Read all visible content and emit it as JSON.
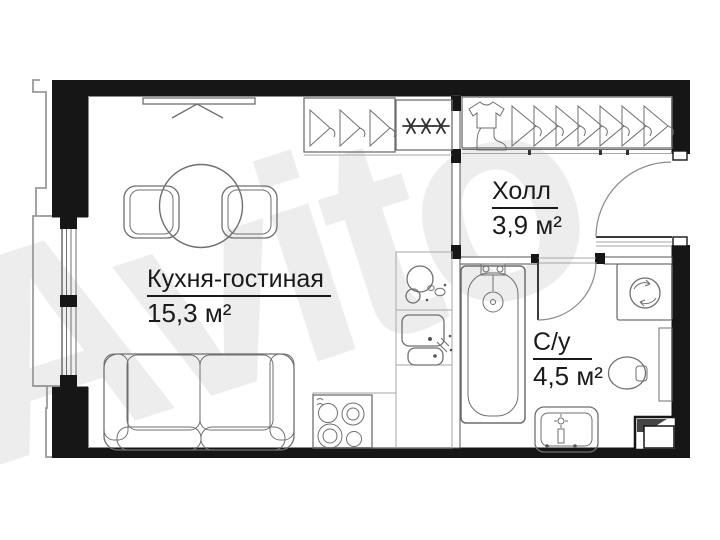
{
  "watermark": {
    "text": "Avito"
  },
  "rooms": {
    "kitchen_living": {
      "name": "Кухня-гостиная",
      "area": "15,3 м²"
    },
    "hall": {
      "name": "Холл",
      "area": "3,9 м²"
    },
    "bathroom": {
      "name": "С/у",
      "area": "4,5 м²"
    }
  },
  "fixtures": [
    "tv-icon",
    "round-dining-table-icon",
    "chair-icon",
    "sofa-icon",
    "wardrobe-hangers-icon",
    "wardrobe-shelves-icon",
    "shirt-icon",
    "boot-icon",
    "kitchen-sink-icon",
    "kitchen-cabinet-icon",
    "stove-icon",
    "bathtub-icon",
    "washing-machine-icon",
    "toilet-icon",
    "washbasin-icon",
    "ventilation-shaft-icon",
    "entrance-door-icon",
    "bathroom-door-icon",
    "window-icon",
    "balcony-outline"
  ],
  "colors": {
    "wall": "#161616",
    "ink": "#1a1a1a",
    "furniture_line": "#6f6f6f",
    "light_line": "#a6a6a6",
    "background": "#ffffff",
    "watermark": "#ededed"
  }
}
